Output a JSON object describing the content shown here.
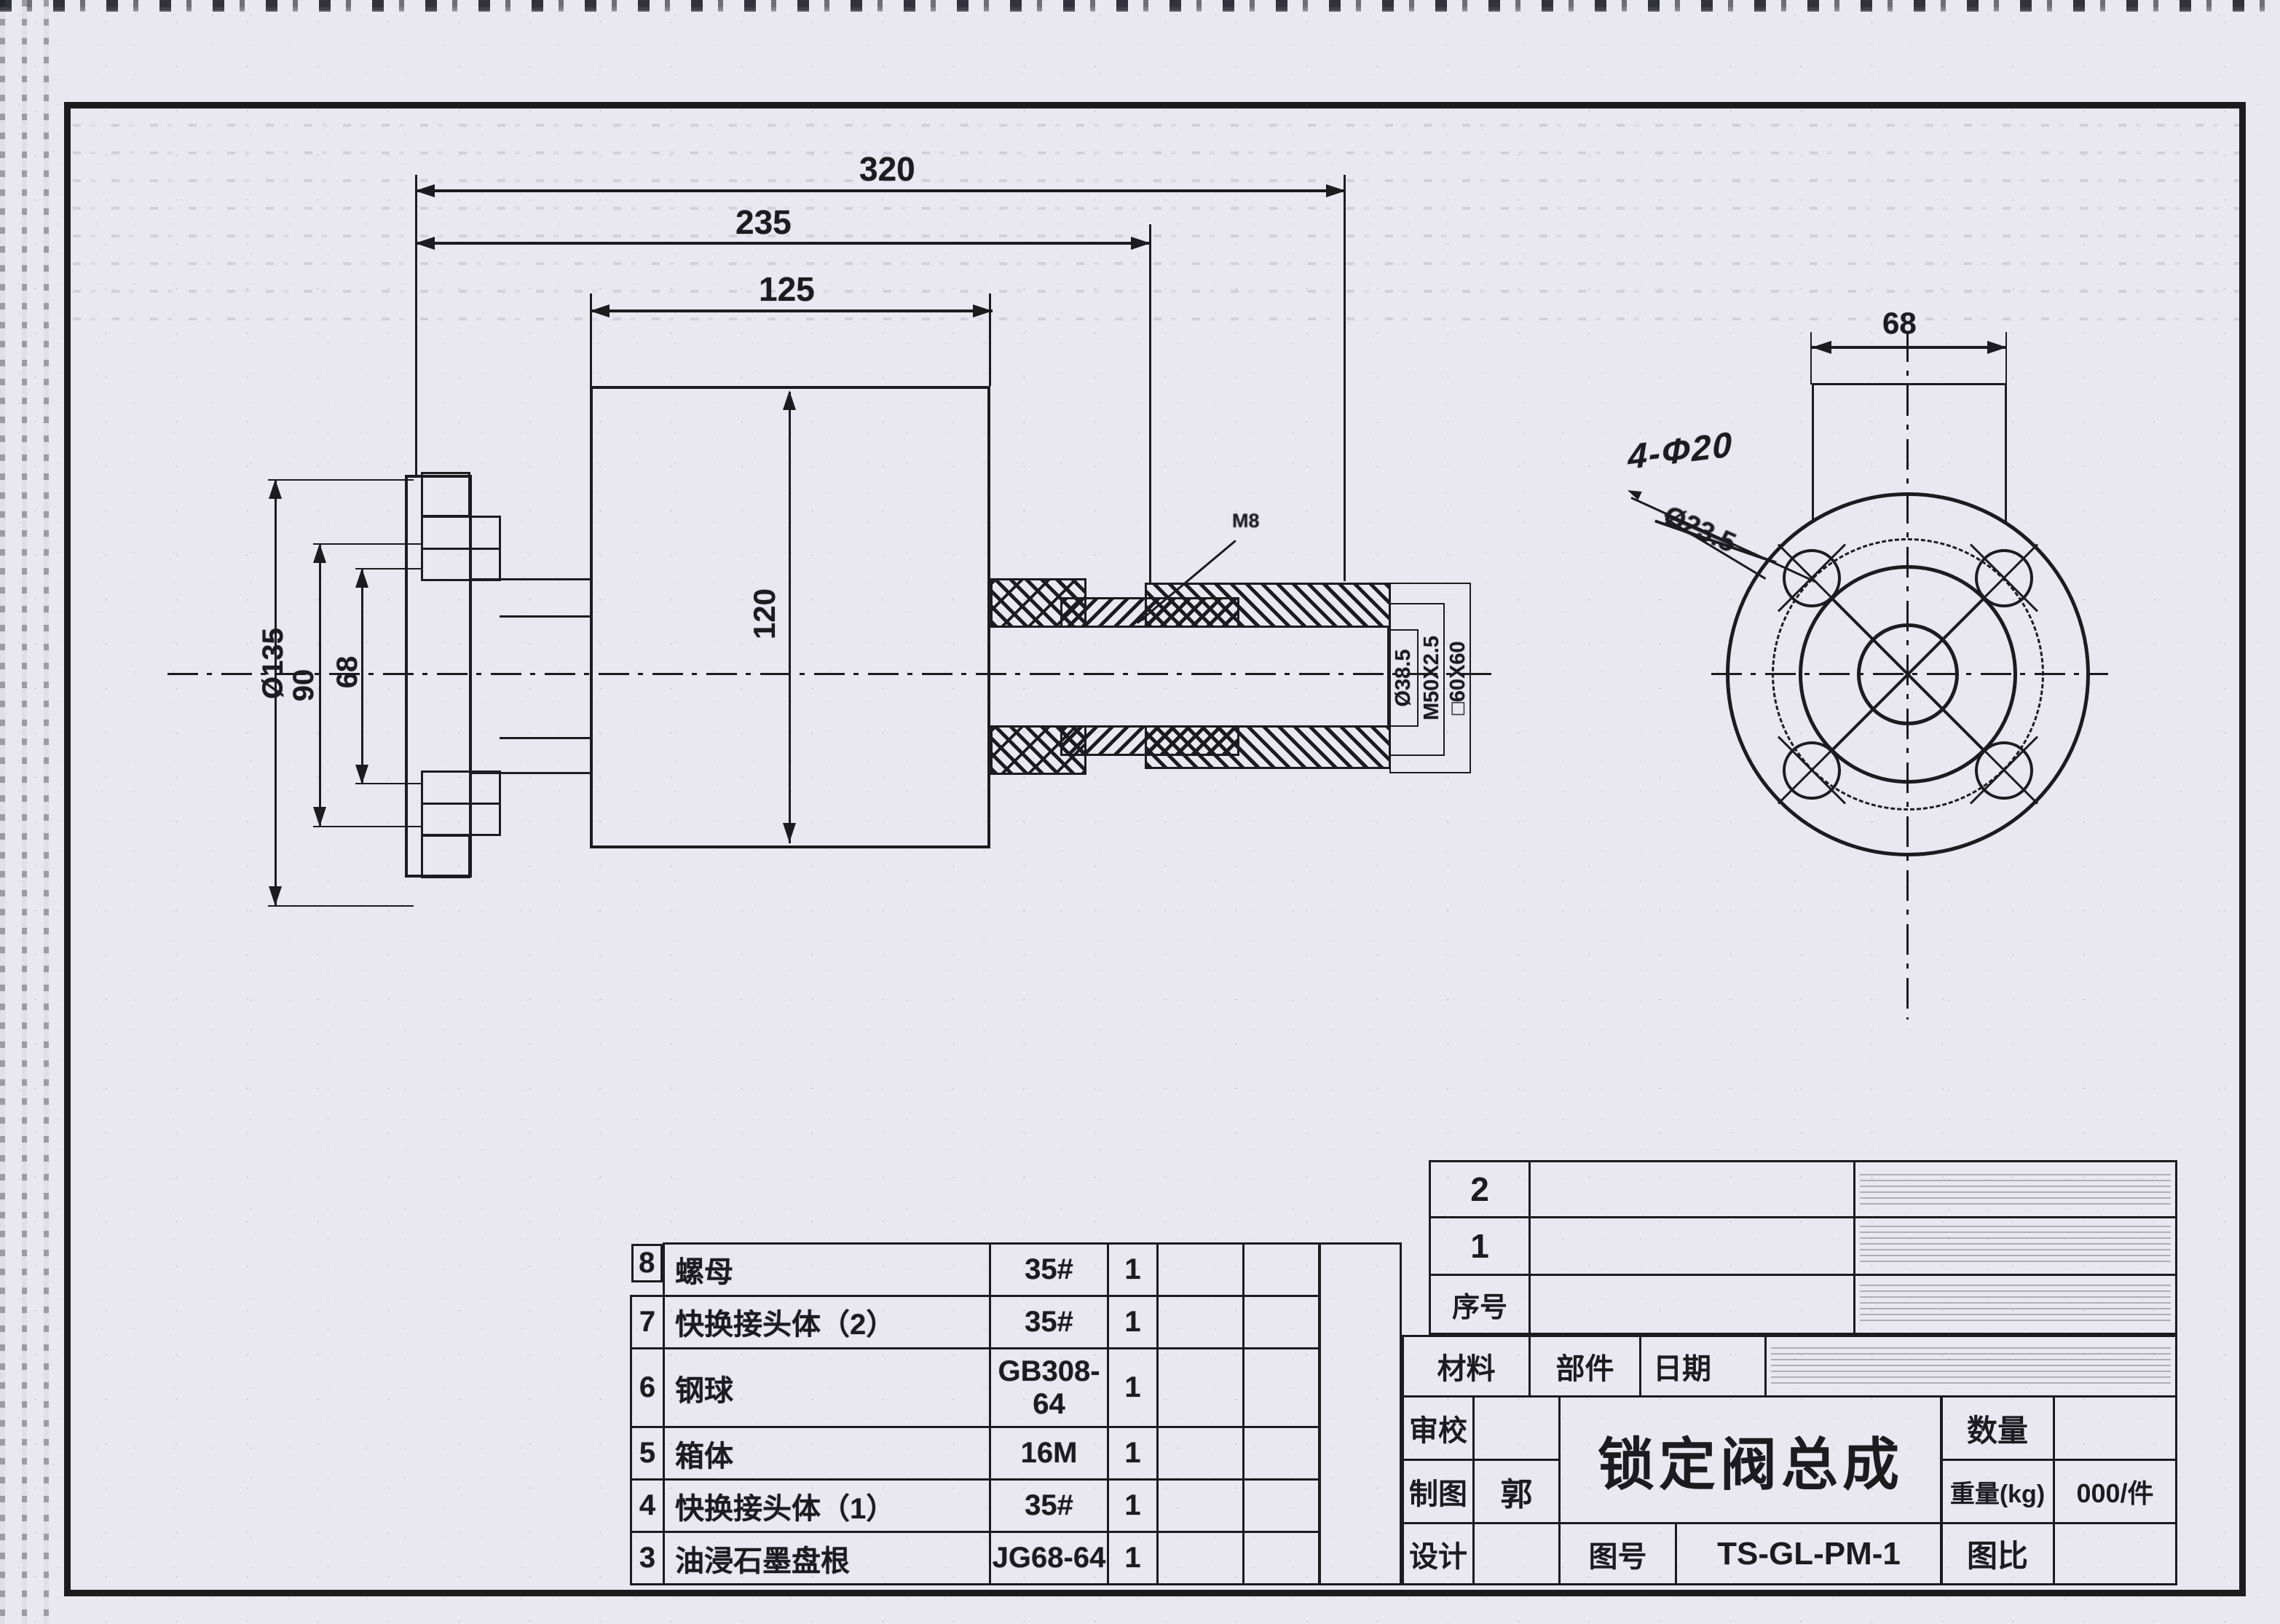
{
  "side_view": {
    "dim_320": "320",
    "dim_235": "235",
    "dim_125": "125",
    "dim_dia135": "Ø135",
    "dim_90": "90",
    "dim_68": "68",
    "dim_120": "120",
    "callout_m8": "M8",
    "label_dia385": "Ø38.5",
    "label_m50": "M50X2.5",
    "label_60x60": "□60X60"
  },
  "end_view": {
    "dim_68": "68",
    "note_handwritten": "4-Φ20",
    "note_struck": "Ø23.5"
  },
  "parts_table": {
    "rows": [
      {
        "no": "8",
        "name": "螺母",
        "spec": "35#",
        "qty": "1"
      },
      {
        "no": "7",
        "name": "快换接头体（2）",
        "spec": "35#",
        "qty": "1"
      },
      {
        "no": "6",
        "name": "钢球",
        "spec": "GB308-64",
        "qty": "1"
      },
      {
        "no": "5",
        "name": "箱体",
        "spec": "16M",
        "qty": "1"
      },
      {
        "no": "4",
        "name": "快换接头体（1）",
        "spec": "35#",
        "qty": "1"
      },
      {
        "no": "3",
        "name": "油浸石墨盘根",
        "spec": "JG68-64",
        "qty": "1"
      }
    ]
  },
  "title_block": {
    "row2": "2",
    "row1": "1",
    "index_label": "序号",
    "material_label": "材料",
    "part_label": "部件",
    "date_label": "日期",
    "review_label": "审校",
    "draft_label": "制图",
    "drafter": "郭",
    "design_label": "设计",
    "title": "锁定阀总成",
    "qty_label": "数量",
    "weight_label": "重量(kg)",
    "weight_value": "000/件",
    "dwgno_label": "图号",
    "dwgno": "TS-GL-PM-1",
    "scale_label": "图比"
  }
}
